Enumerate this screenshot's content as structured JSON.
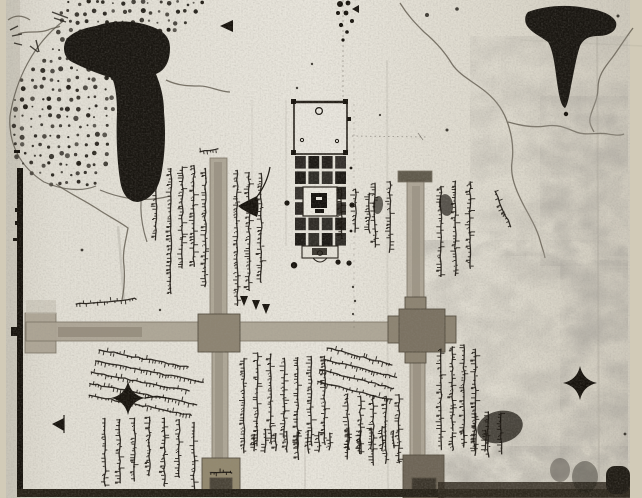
{
  "figure": {
    "kind": "monochrome photograph of a hand-drawn manuscript map",
    "script_note": "handwritten Devanagari annotations, illegible at this resolution",
    "visible_text": ""
  },
  "palette": {
    "page_margin": "#d2cbb8",
    "paper_light": "#e8e5dc",
    "paper_mid": "#ddd9cd",
    "paper_shadow": "#cfcabd",
    "ink": "#17130d",
    "road": "#ada595",
    "road_dark": "#7c7464",
    "junction": "#8d8472",
    "stain": "#6e6557",
    "band": "#272218"
  },
  "map": {
    "regions": [
      {
        "id": "dotted-hill-tract",
        "desc": "stippled hill/grove area, upper left"
      },
      {
        "id": "ink-blot-left",
        "desc": "large vertical ink blot, upper left"
      },
      {
        "id": "ink-blot-right",
        "desc": "funnel-shaped ink blot, upper right"
      },
      {
        "id": "temple-complex",
        "desc": "walled temple with courtyard and cell grid, top center"
      },
      {
        "id": "crossroads",
        "desc": "two vertical roads crossing one horizontal road with junction blocks"
      },
      {
        "id": "river-channels",
        "desc": "wavy stream lines, upper right and left"
      },
      {
        "id": "annotation-blocks",
        "desc": "columns and diagonal lines of Devanagari script"
      },
      {
        "id": "stain-mottling",
        "desc": "water-stain mottling, right third and bottom"
      }
    ],
    "photo": {
      "x": 6,
      "y": 0,
      "w": 624,
      "h": 498
    },
    "dots_region": {
      "polygon": [
        [
          64,
          0
        ],
        [
          206,
          0
        ],
        [
          186,
          30
        ],
        [
          162,
          56
        ],
        [
          150,
          78
        ],
        [
          148,
          96
        ],
        [
          118,
          96
        ],
        [
          114,
          130
        ],
        [
          108,
          164
        ],
        [
          96,
          186
        ],
        [
          62,
          192
        ],
        [
          30,
          176
        ],
        [
          12,
          152
        ],
        [
          8,
          118
        ],
        [
          18,
          84
        ],
        [
          38,
          60
        ],
        [
          56,
          36
        ]
      ],
      "step_x": 9,
      "step_y": 9.5
    },
    "outlines": [
      "M62,22 C34,44 16,78 10,116 C8,146 22,168 44,182 C62,190 82,192 96,186",
      "M100,190 C124,200 148,202 170,196",
      "M146,176 C139,196 139,218 147,242"
    ],
    "blots": [
      {
        "id": "ink-blot-left",
        "d": "M96,26 C112,20 134,20 150,26 C162,30 170,36 170,48 C170,60 166,70 156,74 C160,84 164,96 164,112 C166,134 165,156 161,176 C158,190 150,200 138,202 C128,202 122,194 120,180 C117,160 116,136 117,112 C117,96 115,84 112,78 C98,74 84,68 72,62 C64,58 62,48 66,40 C72,32 84,28 96,26 Z"
      },
      {
        "id": "ink-blot-right",
        "d": "M528,12 C544,6 566,4 586,8 C600,10 612,14 616,22 C618,30 610,36 598,36 C590,36 584,38 580,46 C576,58 574,72 571,86 C569,98 567,106 565,108 C561,106 559,96 557,82 C555,66 553,50 548,42 C540,36 530,32 526,24 C524,18 526,14 528,12 Z"
      }
    ],
    "rivers": [
      {
        "id": "stream-main",
        "d": "M400,3 C408,16 416,24 424,32 C436,42 446,54 452,64 C460,76 474,82 486,92 C498,102 504,112 508,124 C512,136 514,148 512,162 C510,176 516,190 522,202 C528,214 536,226 540,240 C542,248 544,252 545,258"
      },
      {
        "id": "stream-branch-east",
        "d": "M508,122 C522,126 534,128 546,126 C558,124 566,128 576,132 C586,136 598,132 608,134 C614,135 620,136 624,134"
      },
      {
        "id": "stream-right-edge",
        "d": "M633,28 C624,40 618,50 612,58 C604,68 598,76 598,88 C598,100 592,108 590,118 C589,124 592,128 594,132"
      },
      {
        "id": "stream-left-small",
        "d": "M166,80 C178,86 190,86 200,86 C210,86 220,92 230,92"
      },
      {
        "id": "stream-below-blot",
        "d": "M56,184 C70,194 84,200 96,208 C108,216 120,222 128,228 C126,240 122,252 124,266 C125,278 124,290 122,300"
      },
      {
        "id": "squiggle-top-left-a",
        "d": "M8,20 C16,14 24,16 30,20"
      },
      {
        "id": "squiggle-top-left-b",
        "d": "M18,34 C28,30 38,34 48,30 C54,27 58,28 60,26"
      }
    ],
    "stains": [
      {
        "x": 470,
        "y": 36,
        "w": 158,
        "h": 220,
        "op": 0.5
      },
      {
        "x": 412,
        "y": 240,
        "w": 216,
        "h": 256,
        "op": 0.55
      },
      {
        "x": 436,
        "y": 446,
        "w": 192,
        "h": 52,
        "op": 0.7
      },
      {
        "x": 540,
        "y": 96,
        "w": 88,
        "h": 170,
        "op": 0.5
      },
      {
        "x": 560,
        "y": 260,
        "w": 68,
        "h": 200,
        "op": 0.5
      }
    ],
    "roads": {
      "segments": [
        {
          "x": 25,
          "y": 313,
          "w": 31,
          "h": 40
        },
        {
          "x": 26,
          "y": 322,
          "w": 426,
          "h": 19
        },
        {
          "x": 210,
          "y": 158,
          "w": 17,
          "h": 166
        },
        {
          "x": 212,
          "y": 340,
          "w": 16,
          "h": 122
        },
        {
          "x": 407,
          "y": 180,
          "w": 17,
          "h": 134
        },
        {
          "x": 410,
          "y": 344,
          "w": 15,
          "h": 118
        },
        {
          "x": 398,
          "y": 171,
          "w": 34,
          "h": 11,
          "fill": "#5a5345"
        }
      ],
      "cores": [
        {
          "x": 58,
          "y": 327,
          "w": 84,
          "h": 10,
          "op": 0.45
        },
        {
          "x": 214,
          "y": 162,
          "w": 8,
          "h": 158,
          "op": 0.35
        },
        {
          "x": 412,
          "y": 186,
          "w": 8,
          "h": 126,
          "op": 0.3
        },
        {
          "x": 215,
          "y": 344,
          "w": 8,
          "h": 116,
          "op": 0.3
        },
        {
          "x": 413,
          "y": 348,
          "w": 8,
          "h": 110,
          "op": 0.35
        }
      ],
      "junctions": [
        {
          "x": 388,
          "y": 316,
          "w": 68,
          "h": 27,
          "fill": "#8d8472"
        },
        {
          "x": 405,
          "y": 297,
          "w": 21,
          "h": 66,
          "fill": "#8d8472"
        },
        {
          "x": 198,
          "y": 314,
          "w": 42,
          "h": 38,
          "fill": "#8d8472"
        },
        {
          "x": 399,
          "y": 309,
          "w": 46,
          "h": 43,
          "fill": "#7b7262"
        },
        {
          "x": 202,
          "y": 458,
          "w": 38,
          "h": 38,
          "fill": "#93896f"
        },
        {
          "x": 403,
          "y": 455,
          "w": 41,
          "h": 43,
          "fill": "#6e6557"
        },
        {
          "x": 210,
          "y": 478,
          "w": 22,
          "h": 16,
          "fill": "#4a4438"
        },
        {
          "x": 412,
          "y": 478,
          "w": 24,
          "h": 16,
          "fill": "#3c362c"
        }
      ]
    },
    "border": {
      "segments": [
        {
          "x": 17,
          "y": 168,
          "w": 6,
          "h": 160
        },
        {
          "x": 17,
          "y": 336,
          "w": 6,
          "h": 161
        }
      ],
      "notch": {
        "x": 11,
        "y": 327,
        "w": 12,
        "h": 9
      },
      "ticks": [
        {
          "x": 14,
          "y": 150,
          "w": 6,
          "h": 3
        },
        {
          "x": 15,
          "y": 208,
          "w": 8,
          "h": 4
        },
        {
          "x": 15,
          "y": 221,
          "w": 8,
          "h": 4
        },
        {
          "x": 13,
          "y": 238,
          "w": 7,
          "h": 3
        }
      ],
      "patch": {
        "x": 26,
        "y": 300,
        "w": 30,
        "h": 14
      }
    },
    "bottom_band": [
      {
        "x": 17,
        "y": 489,
        "w": 613,
        "h": 8,
        "fill": "#272218"
      },
      {
        "x": 438,
        "y": 482,
        "w": 192,
        "h": 16,
        "fill": "#332c21",
        "op": 0.85
      },
      {
        "x": 606,
        "y": 466,
        "w": 24,
        "h": 28,
        "fill": "#201c15",
        "rx": 9
      }
    ],
    "temple": {
      "courtyard": {
        "x": 294,
        "y": 102,
        "w": 53,
        "h": 52
      },
      "grid": {
        "x": 295,
        "y": 156,
        "cols": 4,
        "rows": 6,
        "cw": 10.8,
        "ch": 12.6,
        "gx": 2.6,
        "gy": 2.8,
        "skip": [
          [
            2,
            1
          ],
          [
            2,
            2
          ],
          [
            3,
            1
          ],
          [
            3,
            2
          ]
        ]
      },
      "shrine": {
        "x": 303,
        "y": 187,
        "w": 34,
        "h": 29,
        "core": {
          "x": 311,
          "y": 193,
          "w": 16,
          "h": 15
        }
      },
      "porch": {
        "x": 302,
        "y": 246,
        "w": 36,
        "h": 12,
        "core": {
          "x": 312,
          "y": 248,
          "w": 15,
          "h": 7
        }
      },
      "arc": "M313,258 Q320,266 327,258",
      "ring": [
        319,
        111,
        3.4
      ],
      "porch_ring": [
        320,
        253,
        2.4
      ],
      "inner_rings": [
        [
          302,
          140
        ],
        [
          337,
          141
        ]
      ],
      "corner_dots": [
        [
          291,
          99
        ],
        [
          343,
          99
        ],
        [
          291,
          150
        ],
        [
          343,
          150
        ]
      ],
      "side_dots": [
        [
          287,
          203,
          2.6
        ],
        [
          352,
          205,
          2.6
        ],
        [
          351,
          168,
          1.4
        ],
        [
          351,
          231,
          1.4
        ]
      ]
    },
    "faint_lines": [
      {
        "d": "M343,0 L343,102",
        "op": 0.35,
        "dash": "2 3"
      },
      {
        "d": "M352,136 L426,137",
        "op": 0.4,
        "dash": "1.5 3"
      },
      {
        "d": "M354,104 L354,330",
        "op": 0.22,
        "dash": "2 4"
      },
      {
        "d": "M286,100 L286,246",
        "op": 0.15,
        "dash": ""
      },
      {
        "d": "M418,133 l5,7",
        "op": 0.5,
        "dash": ""
      }
    ],
    "creases": [
      {
        "d": "M597,8 L599,497",
        "op": 0.12,
        "w": 2
      },
      {
        "d": "M387,60 L388,497",
        "op": 0.09,
        "w": 2
      },
      {
        "d": "M520,40 L642,46",
        "op": 0.08,
        "w": 1.5
      },
      {
        "d": "M252,100 L252,182",
        "op": 0.12,
        "w": 1
      },
      {
        "d": "M305,442 L305,490",
        "op": 0.22,
        "w": 1
      },
      {
        "d": "M118,226 L124,300",
        "op": 0.15,
        "w": 2.5
      }
    ],
    "script_blocks": [
      {
        "id": "upper-left-bracket-col",
        "x": 147,
        "y": 168,
        "w": 15,
        "h": 82,
        "n": 1,
        "orient": "v",
        "tilt": 0
      },
      {
        "id": "upper-left-cols",
        "x": 164,
        "y": 163,
        "w": 46,
        "h": 142,
        "n": 4,
        "orient": "v",
        "tilt": 0
      },
      {
        "id": "upper-left-road-east-cols",
        "x": 230,
        "y": 168,
        "w": 36,
        "h": 138,
        "n": 3,
        "orient": "v",
        "tilt": 0
      },
      {
        "id": "temple-east-near-cols",
        "x": 333,
        "y": 187,
        "w": 42,
        "h": 63,
        "n": 3,
        "orient": "v",
        "tilt": 0
      },
      {
        "id": "temple-east-far-cols",
        "x": 366,
        "y": 178,
        "w": 30,
        "h": 80,
        "n": 2,
        "orient": "v",
        "tilt": 0
      },
      {
        "id": "east-road-right-cols",
        "x": 432,
        "y": 180,
        "w": 44,
        "h": 116,
        "n": 3,
        "orient": "v",
        "tilt": 0
      },
      {
        "id": "east-road-right-diag",
        "x": 486,
        "y": 190,
        "w": 13,
        "h": 58,
        "n": 1,
        "orient": "v",
        "tilt": -24
      },
      {
        "id": "ghat-label-row",
        "x": 73,
        "y": 299,
        "w": 62,
        "h": 12,
        "n": 1,
        "orient": "h",
        "tilt": -5
      },
      {
        "id": "upper-road-head-row",
        "x": 196,
        "y": 148,
        "w": 20,
        "h": 10,
        "n": 1,
        "orient": "h",
        "tilt": -8
      },
      {
        "id": "center-diagonal-lines",
        "x": 96,
        "y": 344,
        "w": 112,
        "h": 58,
        "n": 5,
        "orient": "h",
        "tilt": 11
      },
      {
        "id": "bottom-left-cols",
        "x": 96,
        "y": 416,
        "w": 104,
        "h": 80,
        "n": 7,
        "orient": "v",
        "tilt": 0
      },
      {
        "id": "below-junction1-cols",
        "x": 236,
        "y": 352,
        "w": 94,
        "h": 110,
        "n": 7,
        "orient": "v",
        "tilt": 0
      },
      {
        "id": "junction2-diagonal-lines",
        "x": 324,
        "y": 342,
        "w": 80,
        "h": 46,
        "n": 4,
        "orient": "h",
        "tilt": 14
      },
      {
        "id": "below-junction2-cols",
        "x": 340,
        "y": 390,
        "w": 64,
        "h": 88,
        "n": 5,
        "orient": "v",
        "tilt": 0
      },
      {
        "id": "east-road-lower-cols",
        "x": 434,
        "y": 344,
        "w": 46,
        "h": 112,
        "n": 4,
        "orient": "v",
        "tilt": 0
      },
      {
        "id": "east-far-lower-cols",
        "x": 468,
        "y": 408,
        "w": 38,
        "h": 52,
        "n": 3,
        "orient": "v",
        "tilt": 0
      },
      {
        "id": "bottom-mid-short-cols-a",
        "x": 248,
        "y": 428,
        "w": 86,
        "h": 26,
        "n": 8,
        "orient": "v",
        "tilt": 0
      },
      {
        "id": "bottom-mid-short-cols-b",
        "x": 342,
        "y": 426,
        "w": 56,
        "h": 30,
        "n": 5,
        "orient": "v",
        "tilt": 0
      },
      {
        "id": "bottom-east-short-cols",
        "x": 446,
        "y": 428,
        "w": 44,
        "h": 26,
        "n": 4,
        "orient": "v",
        "tilt": 0
      },
      {
        "id": "junction3-scribble",
        "x": 208,
        "y": 468,
        "w": 28,
        "h": 10,
        "n": 1,
        "orient": "h",
        "tilt": 0
      }
    ],
    "smudges": [
      {
        "cx": 446,
        "cy": 205,
        "rx": 7,
        "ry": 11,
        "rot": -8,
        "op": 0.7
      },
      {
        "cx": 378,
        "cy": 205,
        "rx": 5,
        "ry": 9,
        "rot": 6,
        "op": 0.65
      },
      {
        "cx": 500,
        "cy": 427,
        "rx": 23,
        "ry": 16,
        "rot": -12,
        "op": 0.75
      },
      {
        "cx": 585,
        "cy": 477,
        "rx": 13,
        "ry": 16,
        "rot": 0,
        "op": 0.4
      },
      {
        "cx": 560,
        "cy": 470,
        "rx": 10,
        "ry": 12,
        "rot": 0,
        "op": 0.35
      }
    ],
    "markers": [
      {
        "id": "triangle-marker-top",
        "d": "M233,20 L233,32 L220,26 Z",
        "fill": true
      },
      {
        "id": "triangle-marker-top-small",
        "d": "M359,5 L359,13 L352,9 Z",
        "fill": true
      },
      {
        "id": "triangle-marker-bottom-left",
        "d": "M64,418 L64,431 L52,424 Z",
        "fill": true
      },
      {
        "id": "triangle-stem-bottom-left",
        "d": "M64,415 L64,433",
        "stroke": true
      },
      {
        "id": "flag-marker",
        "d": "M257,196 C249,200 243,203 238,206 C244,211 251,214 257,217 C259,211 259,202 257,196 Z",
        "fill": true
      },
      {
        "id": "flag-curve",
        "d": "M256,198 C263,189 268,179 270,167",
        "stroke": true
      },
      {
        "id": "star-marker-left",
        "d": "M128,381 Q131,395 145,398 Q131,401 128,415 Q125,401 111,398 Q125,395 128,381 Z",
        "fill": true
      },
      {
        "id": "star-tail-left",
        "d": "M145,398 C155,396 164,397 171,399",
        "stroke": true
      },
      {
        "id": "star-marker-right",
        "d": "M580,366 Q583,380 597,383 Q583,386 580,400 Q577,386 563,383 Q577,380 580,366 Z",
        "fill": true
      },
      {
        "id": "column-tail-arrows",
        "d": "M240,296 l4,10 l4,-10 Z M252,300 l4,10 l4,-10 Z M262,304 l4,10 l4,-10 Z",
        "fill": true
      },
      {
        "id": "tree-dots",
        "d": "M294,262 a3.2,3.2 0 1,0 0.1,0 Z M338,259.5 a2.6,2.6 0 1,0 0.1,0 Z M349,260.5 a2.6,2.6 0 1,0 0.1,0 Z",
        "fill": true
      }
    ],
    "ink_dots": [
      [
        340,
        4,
        3
      ],
      [
        348,
        3,
        2.4
      ],
      [
        338,
        13,
        2
      ],
      [
        346,
        13,
        2.4
      ],
      [
        352,
        21,
        2
      ],
      [
        341,
        25,
        2.1
      ],
      [
        347,
        32,
        1.8
      ],
      [
        343,
        40,
        1.6
      ],
      [
        566,
        114,
        2.2
      ]
    ],
    "specks": [
      [
        427,
        15,
        2
      ],
      [
        457,
        9,
        1.8
      ],
      [
        447,
        130,
        1.5
      ],
      [
        297,
        88,
        1.2
      ],
      [
        82,
        250,
        1.4
      ],
      [
        618,
        16,
        1.5
      ],
      [
        625,
        434,
        1.4
      ],
      [
        160,
        310,
        1.2
      ],
      [
        353,
        287,
        1.2
      ],
      [
        355,
        301,
        1.2
      ],
      [
        353,
        314,
        1.1
      ],
      [
        312,
        64,
        1.2
      ],
      [
        380,
        115,
        1.1
      ]
    ],
    "scribbles": [
      "M10,30 l8,-4 M12,36 l10,-2 M14,43 l8,2",
      "M30,46 l8,6 M36,40 l3,12",
      "M52,12 l16,6 M54,18 l12,4"
    ]
  }
}
